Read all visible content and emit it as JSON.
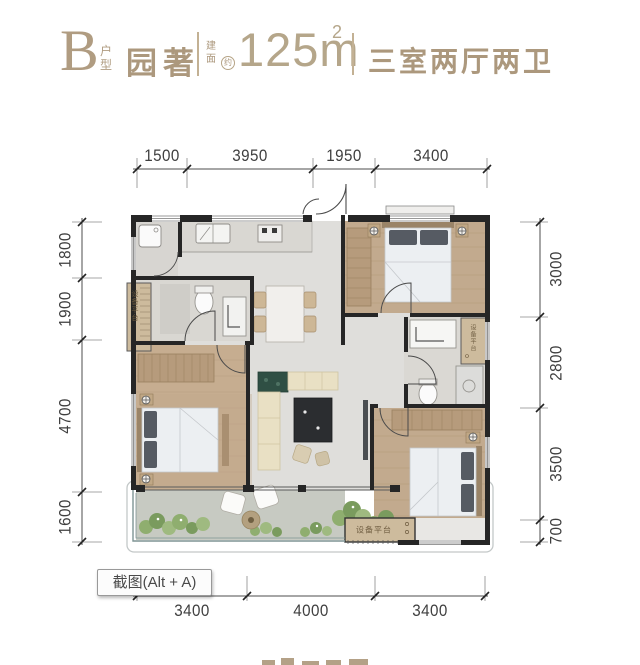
{
  "header": {
    "unit_letter": "B",
    "unit_type_label": "户型",
    "project_name": "园著",
    "area_prefix": "建面",
    "area_approx_mark": "约",
    "area_value": "125m",
    "area_superscript": "2",
    "rooms_text": "三室两厅两卫"
  },
  "dimensions": {
    "top": [
      "1500",
      "3950",
      "1950",
      "3400"
    ],
    "bottom": [
      "3400",
      "4000",
      "3400"
    ],
    "left": [
      "1800",
      "1900",
      "4700",
      "1600"
    ],
    "right": [
      "3000",
      "2800",
      "3500",
      "700"
    ]
  },
  "plan": {
    "equipment_platform_left": "设备平台",
    "equipment_platform_right": "设备平台",
    "equipment_platform_bottom": "设备平台"
  },
  "overlay": {
    "screenshot_button": "截图(Alt + A)"
  },
  "colors": {
    "brand_gold": "#b09c81",
    "wall_black": "#262626",
    "wood_floor": "#c4ab8e",
    "tile_floor": "#dad8d3",
    "marble_floor": "#dfdedb",
    "balcony_floor": "#c7cac2",
    "plant_green": "#8fae6f",
    "equipment_tan": "#cdbb9d"
  }
}
